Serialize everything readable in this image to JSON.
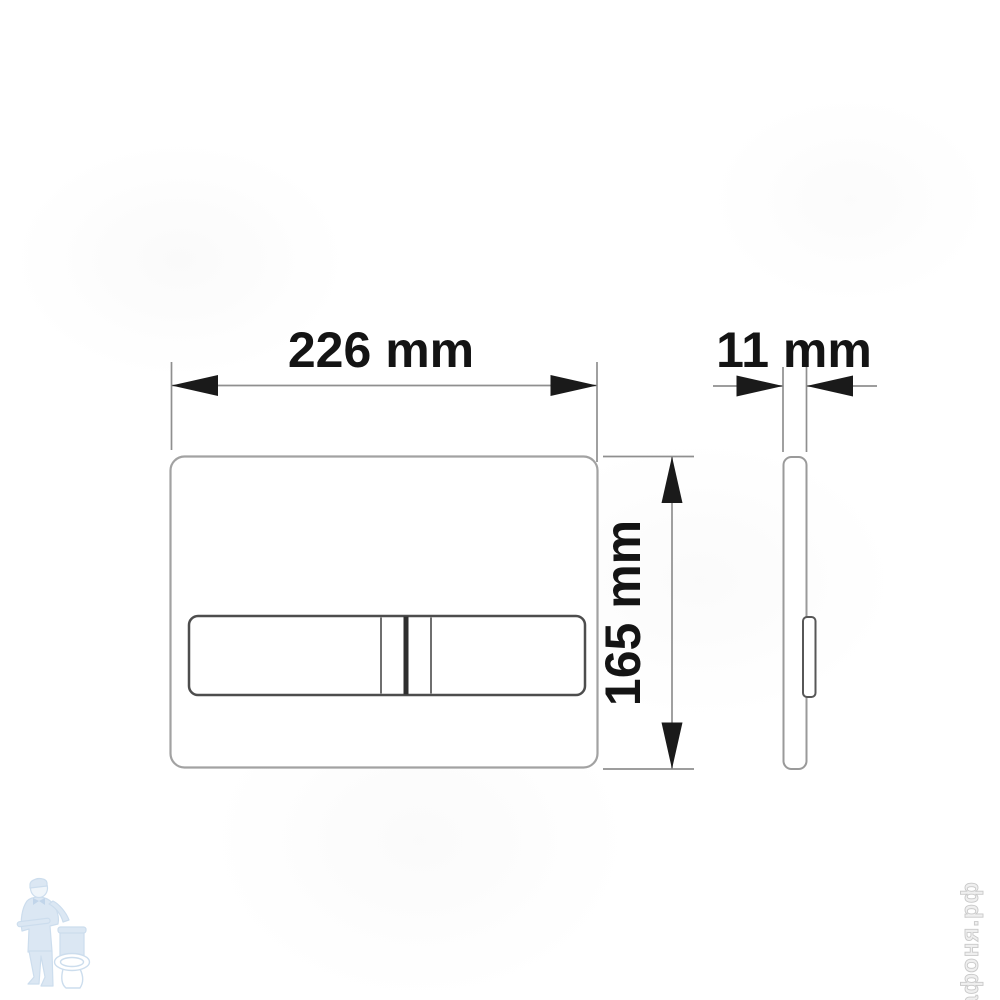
{
  "drawing": {
    "dimensions": {
      "width": "226 mm",
      "depth": "11 mm",
      "height": "165 mm"
    },
    "watermarks": {
      "site": "афоня.рф"
    },
    "colors": {
      "background": "#ffffff",
      "dimension_text": "#141414",
      "arrow_fill": "#1a1a1a",
      "dimension_line": "#8f8f8f",
      "plate_outline": "#a2a2a2",
      "button_outline": "#4d4d4d",
      "divider_dark": "#2e2e2e",
      "logo_blue": "#bfd4ea",
      "site_watermark_gray": "#c9c9c9"
    }
  }
}
